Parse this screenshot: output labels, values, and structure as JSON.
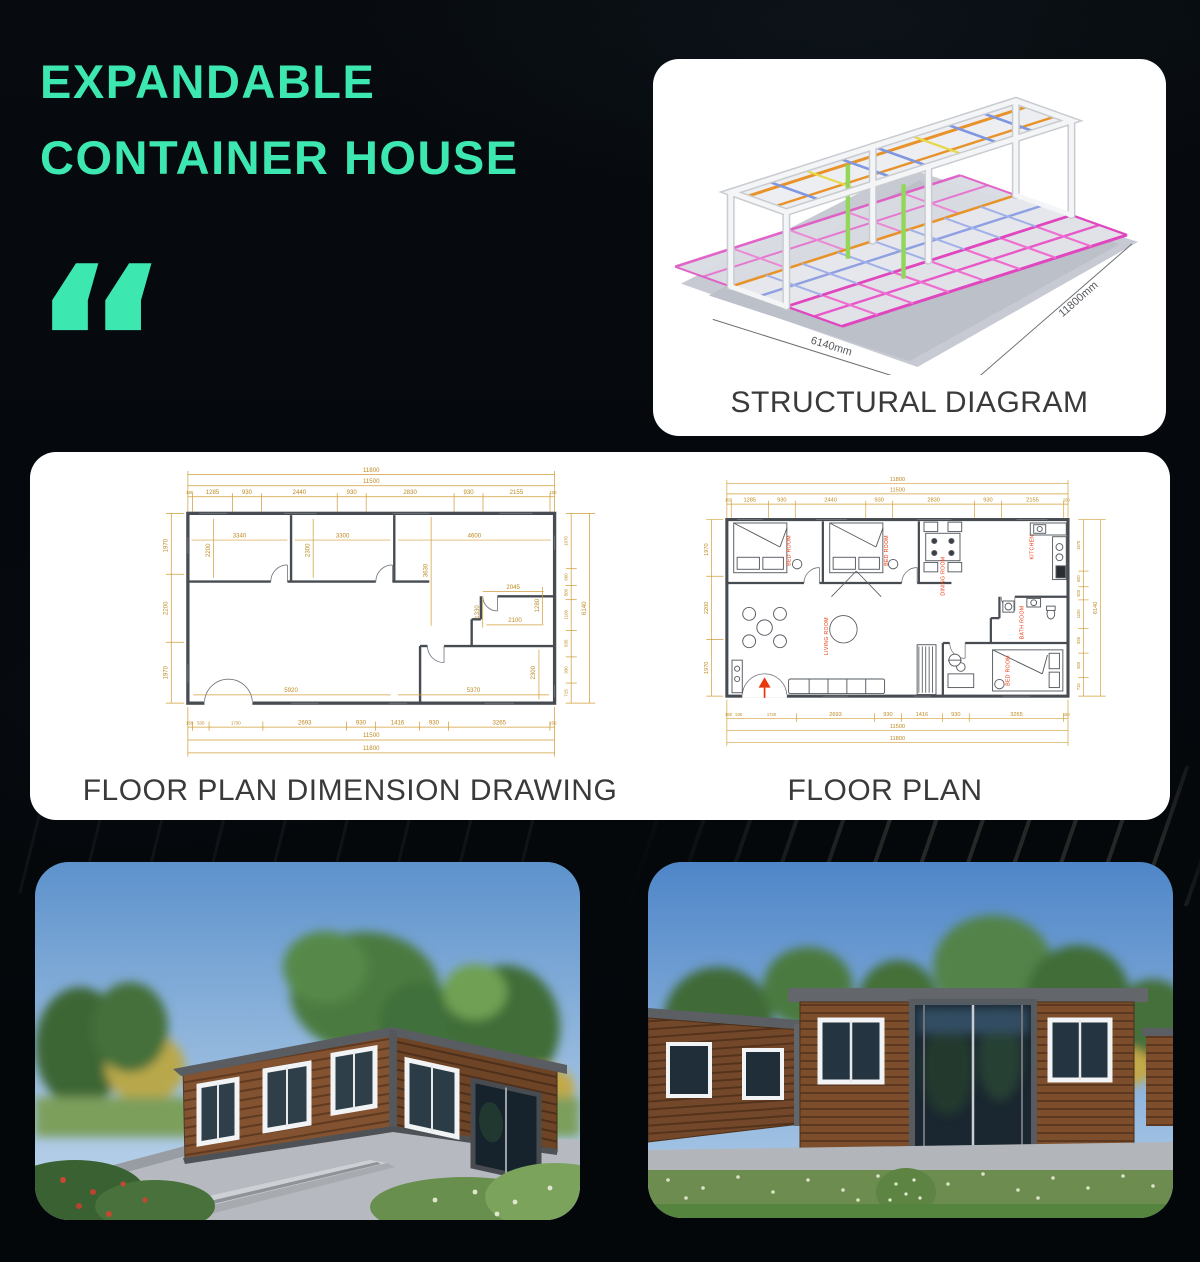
{
  "page": {
    "accent": "#3de8b0",
    "background": "#05080c"
  },
  "header": {
    "title_line1": "EXPANDABLE",
    "title_line2": "CONTAINER HOUSE",
    "quote_glyph": "“"
  },
  "structural": {
    "caption": "STRUCTURAL DIAGRAM",
    "dim_width": "6140mm",
    "dim_length": "11800mm"
  },
  "floorplan": {
    "left_caption": "FLOOR PLAN DIMENSION DRAWING",
    "right_caption": "FLOOR PLAN",
    "dims": {
      "total_top": "11800",
      "total_inner": "11500",
      "end_seg": "150",
      "top_segments": [
        "150",
        "1285",
        "930",
        "2440",
        "930",
        "2830",
        "930",
        "2155",
        "150"
      ],
      "bottom_segments": [
        "150",
        "530",
        "1730",
        "2693",
        "930",
        "1416",
        "930",
        "3265",
        "150"
      ],
      "left_side": [
        "1970",
        "2200",
        "1970"
      ],
      "right_side": [
        "1970",
        "600",
        "500",
        "1100",
        "935",
        "930",
        "715"
      ],
      "side_total": "6140",
      "interior": {
        "a": "3340",
        "b": "3300",
        "c": "4600",
        "d": "2300",
        "e": "2200",
        "f": "3630",
        "g": "2045",
        "h": "1330",
        "i": "2100",
        "j": "1280",
        "k": "5920",
        "l": "5370",
        "m": "2300"
      }
    },
    "rooms": {
      "bed1": "BED ROOM",
      "bed2": "BED ROOM",
      "dining": "DINING ROOM",
      "kitchen": "KITCHEN",
      "living": "LIVING ROOM",
      "bath": "BATH ROOM",
      "bed3": "BED ROOM"
    }
  }
}
